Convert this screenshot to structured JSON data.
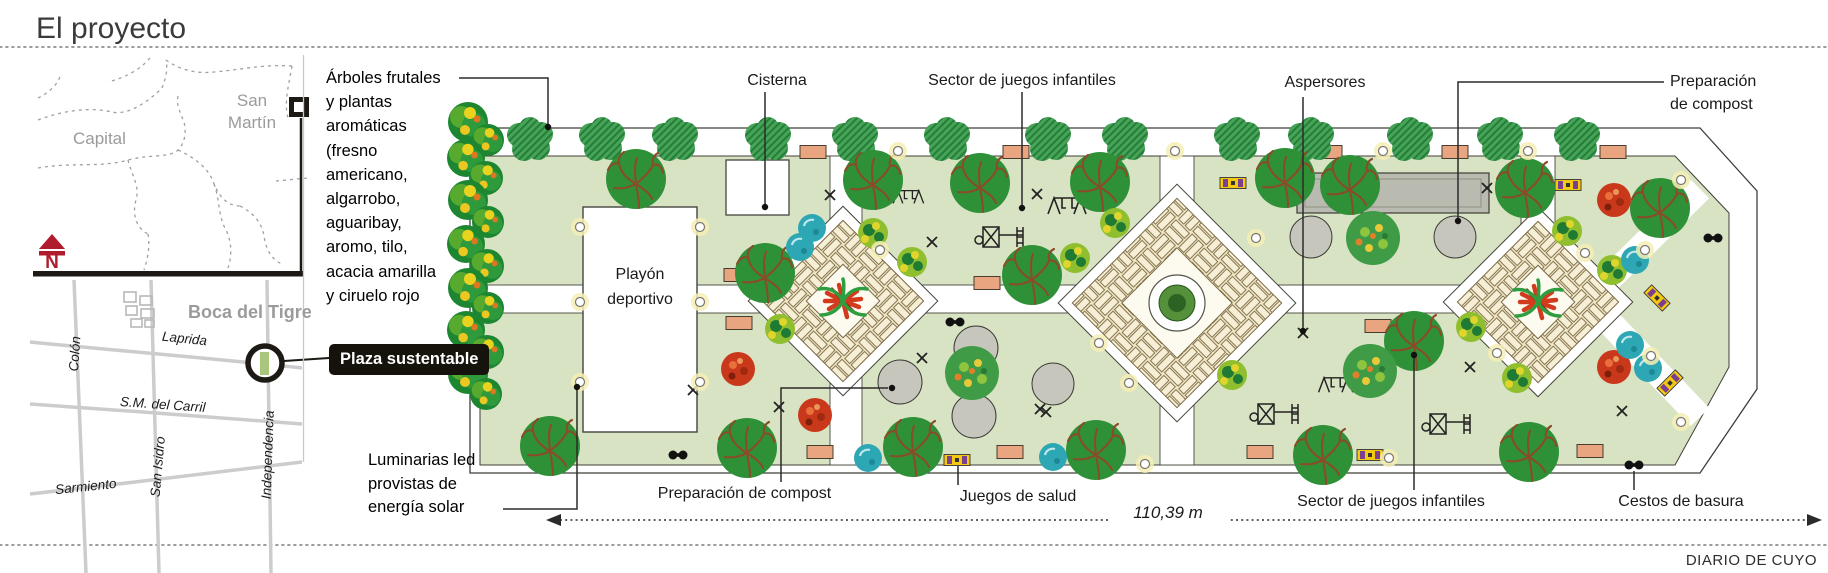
{
  "header": {
    "title": "El proyecto"
  },
  "map": {
    "capital_label": "Capital",
    "san_martin_label": "San Martín",
    "district_label": "Boca del Tigre",
    "callout_label": "Plaza sustentable",
    "compass_letter": "N",
    "streets": {
      "colon": "Colón",
      "laprida": "Laprida",
      "carril": "S.M. del Carril",
      "san_isidro": "San Isidro",
      "sarmiento": "Sarmiento",
      "independencia": "Independencia"
    }
  },
  "plan": {
    "trees_note_lines": [
      "Árboles frutales",
      "y plantas",
      "aromáticas",
      "(fresno",
      "americano,",
      "algarrobo,",
      "aguaribay,",
      "aromo, tilo,",
      "acacia amarilla",
      "y ciruelo rojo"
    ],
    "lights_note_lines": [
      "Luminarias led",
      "provistas de",
      "energía solar"
    ],
    "labels": {
      "cisterna": "Cisterna",
      "playground_top": "Sector de juegos infantiles",
      "sprinklers": "Aspersores",
      "compost_top_line1": "Preparación",
      "compost_top_line2": "de compost",
      "court_line1": "Playón",
      "court_line2": "deportivo",
      "compost_bottom": "Preparación de compost",
      "health_games": "Juegos de salud",
      "length": "110,39 m",
      "playground_bottom": "Sector de juegos infantiles",
      "trash_bins": "Cestos de basura"
    }
  },
  "footer": {
    "credit": "DIARIO DE CUYO"
  },
  "colors": {
    "park_green": "#d8e3c3",
    "pavement_tan": "#f3ecd0",
    "tree_dark_green": "#2e9138",
    "tree_hatch_green": "#46a458",
    "bench_salmon": "#e9a480",
    "water_teal": "#2ea7b5",
    "compost_gray": "#c6c6bd",
    "marker_red": "#b01c2e",
    "callout_bg": "#15130b"
  }
}
